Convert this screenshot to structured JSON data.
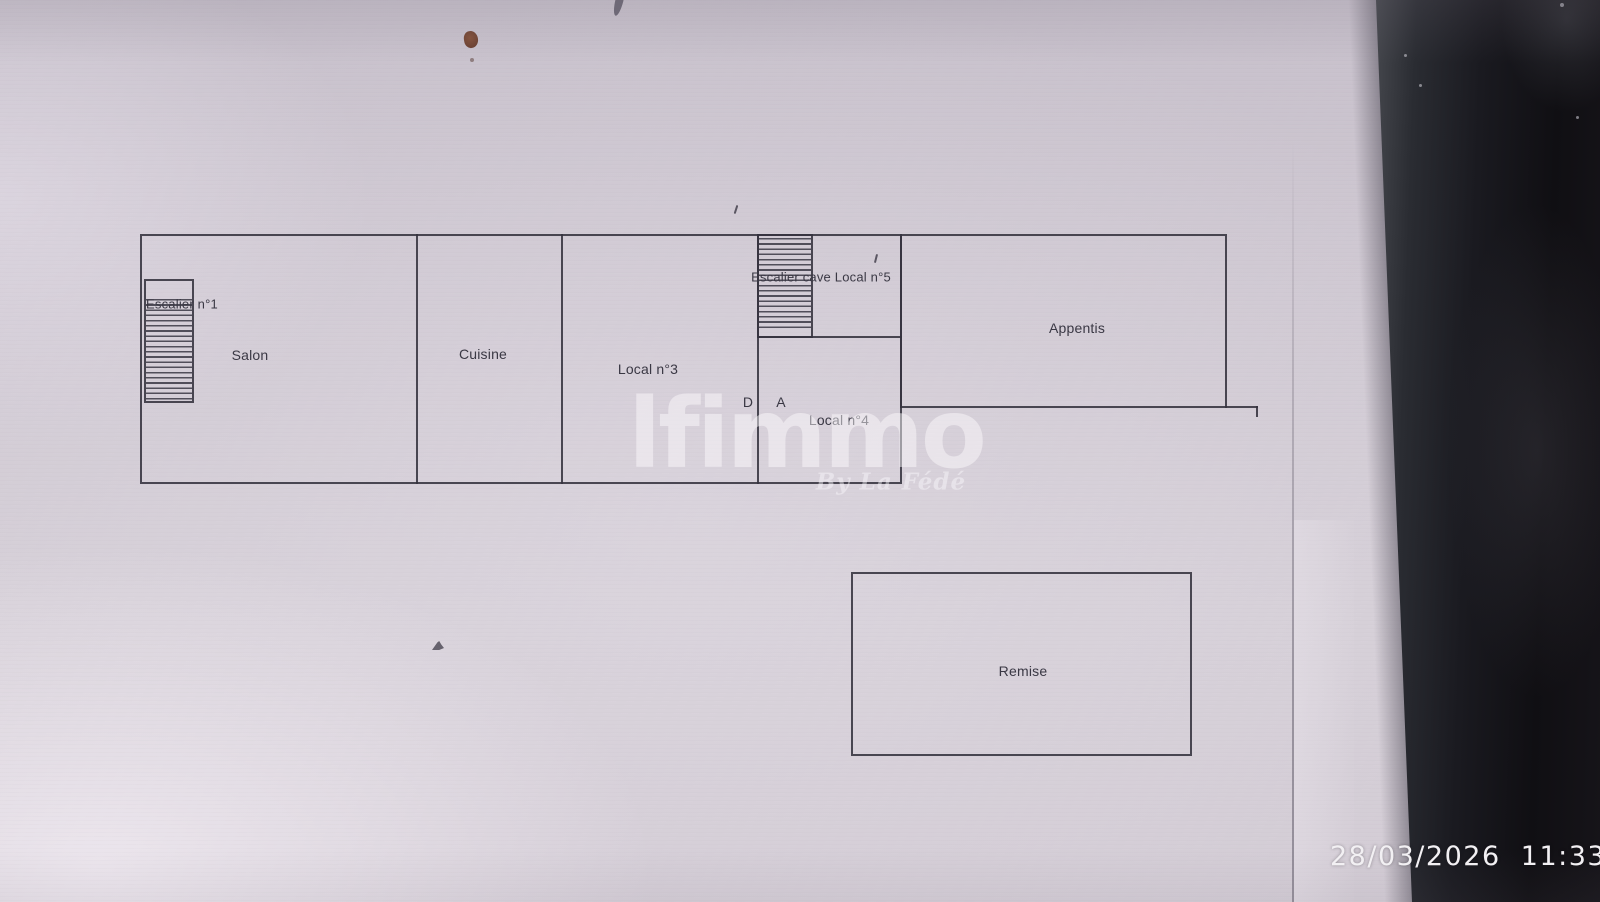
{
  "plan": {
    "labels": {
      "salon": "Salon",
      "cuisine": "Cuisine",
      "local3": "Local n°3",
      "escalier1": "Escalier n°1",
      "escalier_cave_local5": "Escalier cave Local n°5",
      "appentis": "Appentis",
      "local4": "Local n°4",
      "remise": "Remise",
      "door_d": "D",
      "door_a": "A"
    }
  },
  "watermark": {
    "brand": "lfimmo",
    "byline": "By La Fédé"
  },
  "camera_overlay": {
    "timestamp": "28/03/2026  11:33"
  },
  "colors": {
    "screen_background": "#d2cbd4",
    "plan_line": "#34323e",
    "dark_band": "#121016",
    "timestamp_text": "#f2f0f3",
    "watermark_text": "rgba(252,250,253,0.48)",
    "brown_spot": "#7a4a38"
  },
  "artifacts": [
    "smudge-mark-top",
    "brown-spot",
    "brown-dot",
    "tick-mark-above-plan",
    "tick-mark-near-n5",
    "speck-bottom-left",
    "dust-specks-on-bezel"
  ]
}
